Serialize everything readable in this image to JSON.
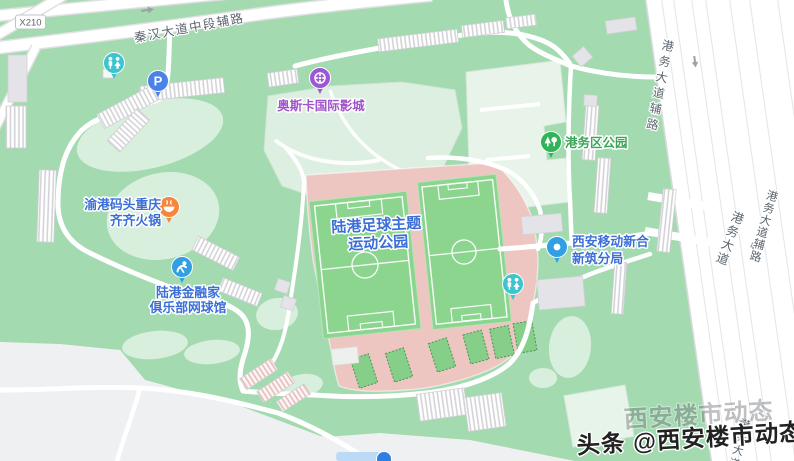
{
  "map_labels": {
    "route_badge": "X210",
    "top_road": "秦汉大道中段辅路",
    "right_road_inner": "港务大道辅路",
    "right_road_main": "港务大道",
    "right_road_outer": "港务大道辅路",
    "bottom_right_road": "港务大道"
  },
  "pois": {
    "cinema": {
      "name": "奥斯卡国际影城"
    },
    "district_park": {
      "name": "港务区公园"
    },
    "hotpot": {
      "line1": "渝港码头重庆",
      "line2": "齐齐火锅"
    },
    "tennis_club": {
      "line1": "陆港金融家",
      "line2": "俱乐部网球馆"
    },
    "football_park": {
      "line1": "陆港足球主题",
      "line2": "运动公园"
    },
    "mobile_branch": {
      "line1": "西安移动新合",
      "line2": "新筑分局"
    },
    "parking": {
      "letter": "P"
    }
  },
  "watermark": {
    "text": "头条 @西安楼市动态",
    "ghost": "西安楼市动态"
  },
  "colors": {
    "park_green": "#a3dab0",
    "lawn_light": "#d9efdd",
    "land_gray": "#eff0f1",
    "sports_pink": "#edc6c2",
    "field_green": "#8cd58f",
    "court_green": "#85cf89",
    "road_text": "#5d6670",
    "poi_text_blue": "#3b6fd7",
    "poi_purple": "#9c58d4",
    "poi_purple_text": "#a153cb",
    "poi_green": "#2fb558",
    "poi_green_text": "#3aa657",
    "poi_orange": "#f6863d",
    "poi_teal": "#3ec4ce",
    "poi_blue": "#339fe3",
    "watermark_dark": "#222222"
  }
}
